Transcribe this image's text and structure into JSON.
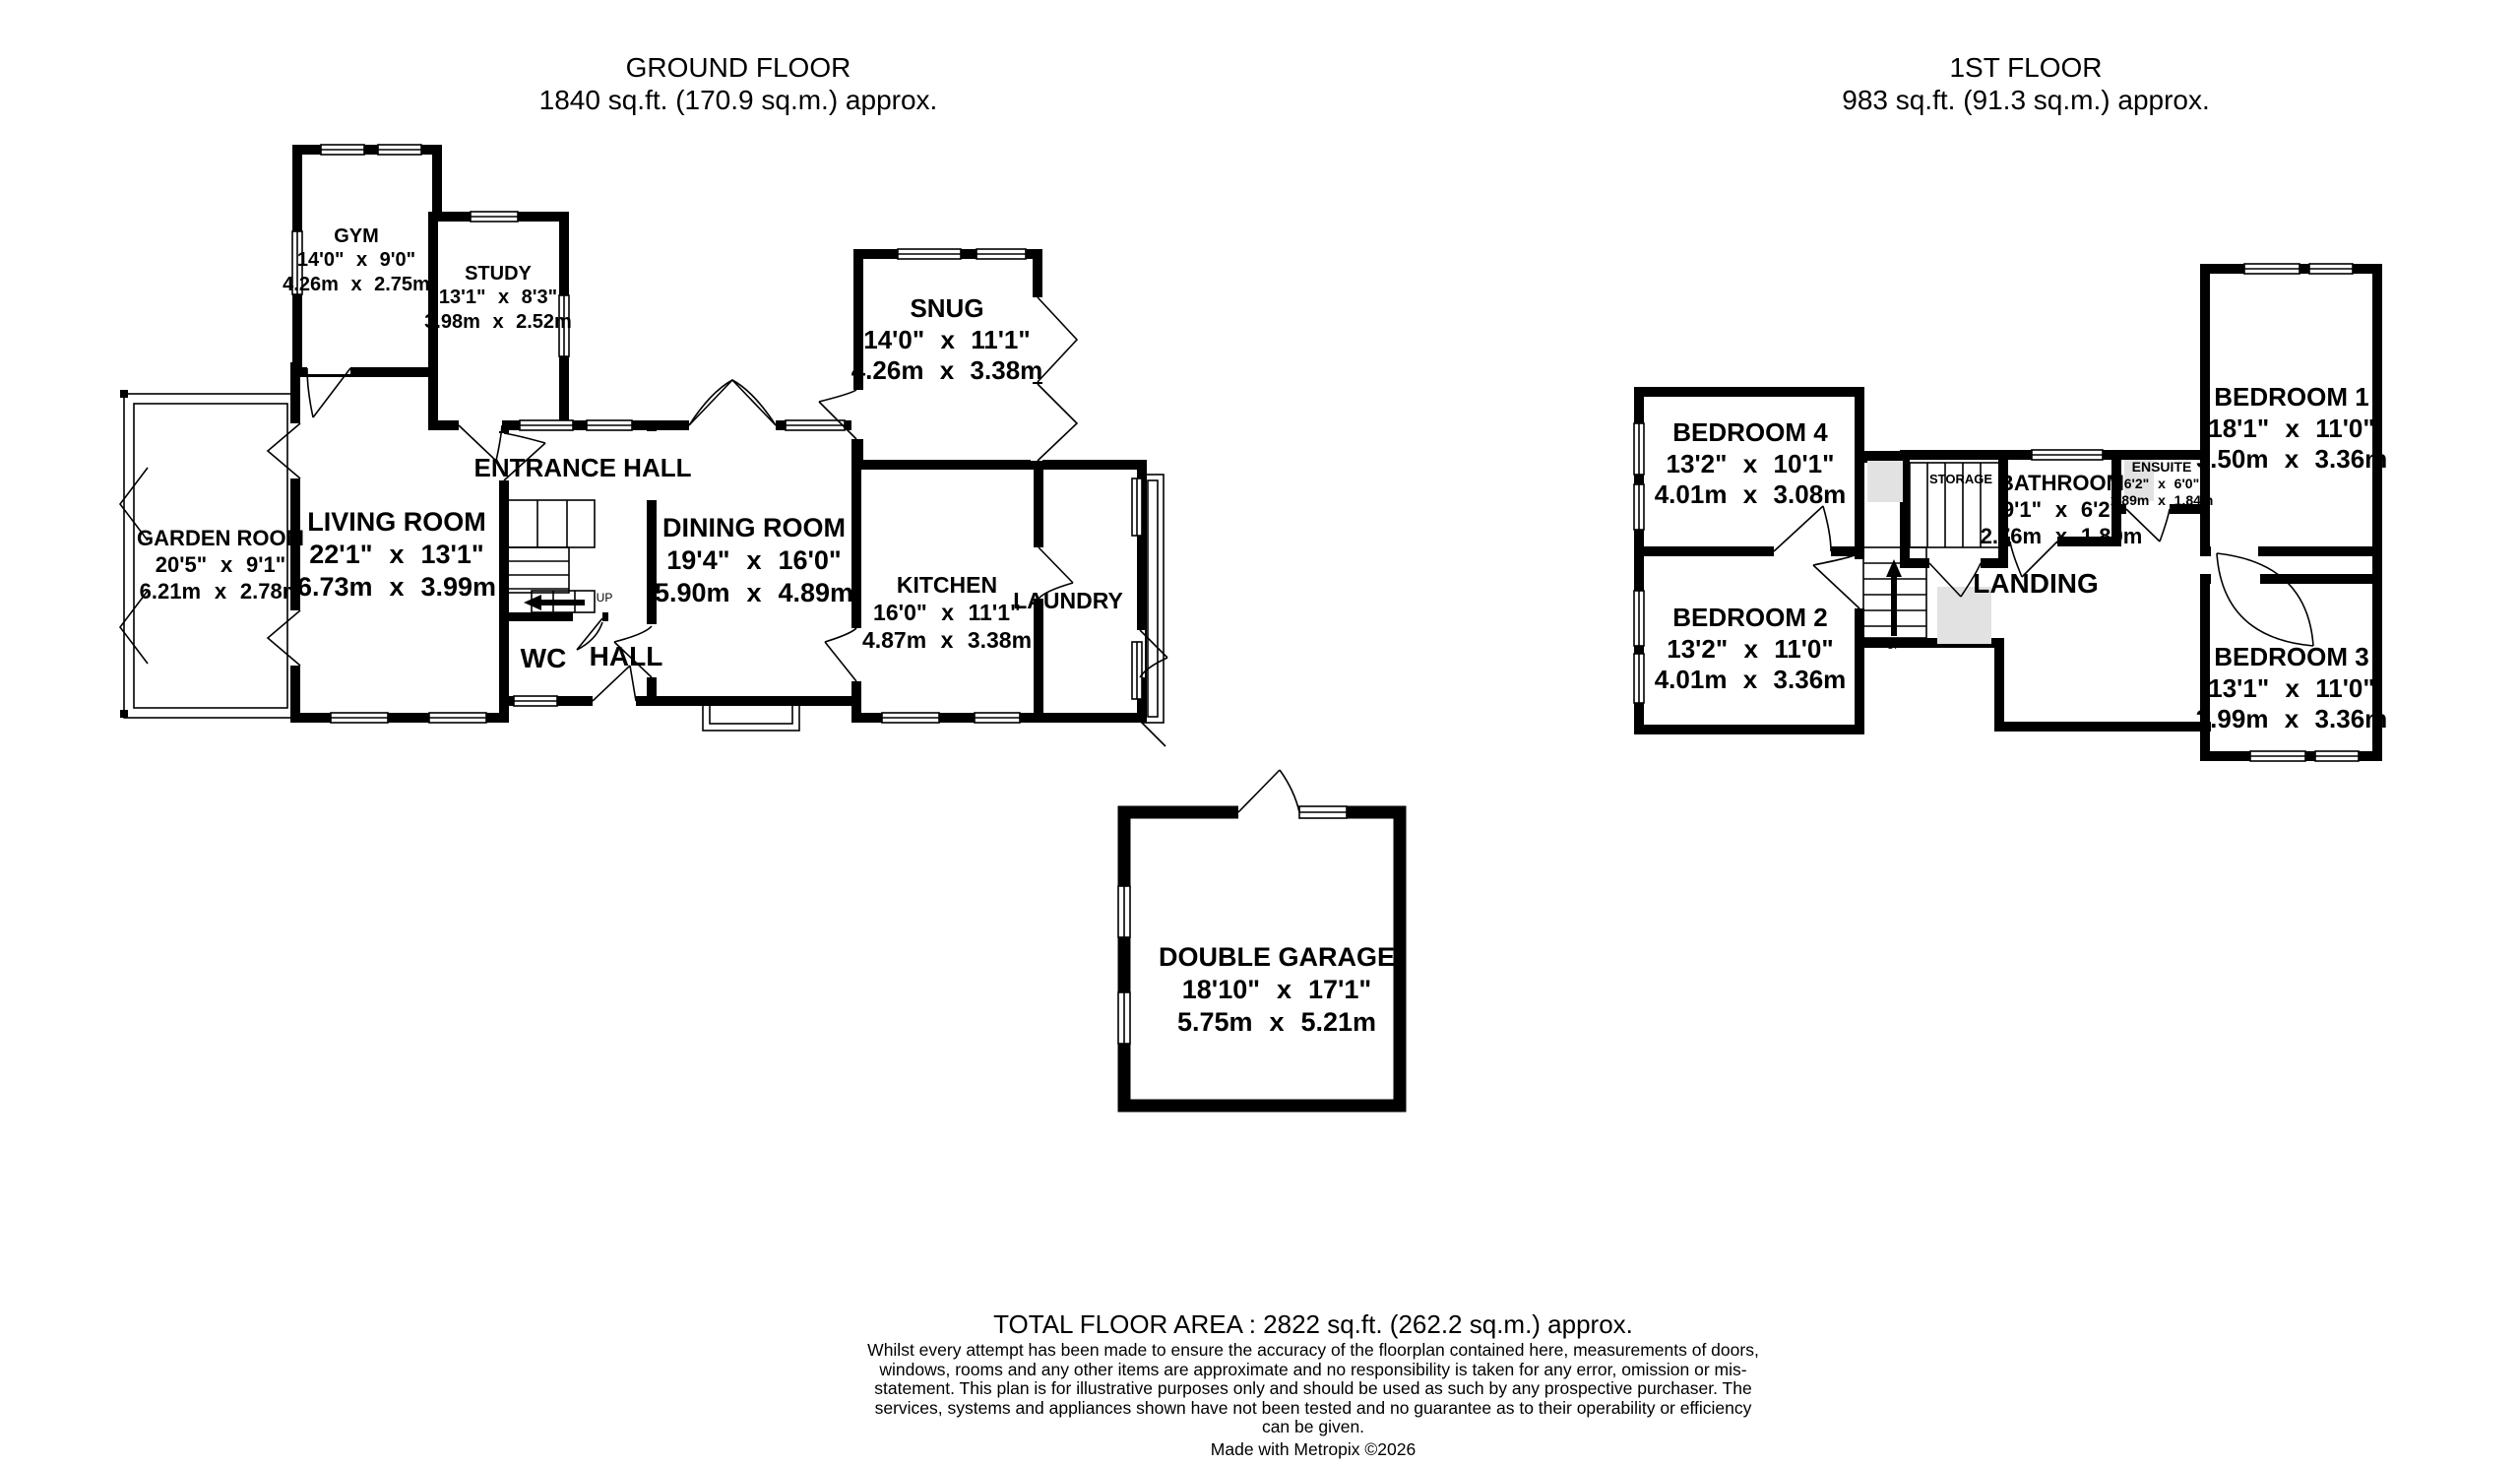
{
  "colors": {
    "wall": "#000000",
    "background": "#ffffff",
    "shading": "#e2e2e2"
  },
  "ground_floor": {
    "title": "GROUND FLOOR",
    "area": "1840 sq.ft. (170.9 sq.m.) approx.",
    "rooms": {
      "gym": {
        "name": "GYM",
        "imperial": "14'0\" x 9'0\"",
        "metric": "4.26m x 2.75m"
      },
      "study": {
        "name": "STUDY",
        "imperial": "13'1\" x 8'3\"",
        "metric": "3.98m x 2.52m"
      },
      "snug": {
        "name": "SNUG",
        "imperial": "14'0\" x 11'1\"",
        "metric": "4.26m x 3.38m"
      },
      "garden_room": {
        "name": "GARDEN ROOM",
        "imperial": "20'5\" x 9'1\"",
        "metric": "6.21m x 2.78m"
      },
      "living_room": {
        "name": "LIVING ROOM",
        "imperial": "22'1\" x 13'1\"",
        "metric": "6.73m x 3.99m"
      },
      "dining_room": {
        "name": "DINING ROOM",
        "imperial": "19'4\" x 16'0\"",
        "metric": "5.90m x 4.89m"
      },
      "kitchen": {
        "name": "KITCHEN",
        "imperial": "16'0\" x 11'1\"",
        "metric": "4.87m x 3.38m"
      },
      "entrance_hall": {
        "name": "ENTRANCE HALL"
      },
      "laundry": {
        "name": "LAUNDRY"
      },
      "wc": {
        "name": "WC"
      },
      "hall": {
        "name": "HALL"
      },
      "up": "UP"
    }
  },
  "first_floor": {
    "title": "1ST FLOOR",
    "area": "983 sq.ft. (91.3 sq.m.) approx.",
    "rooms": {
      "bedroom1": {
        "name": "BEDROOM 1",
        "imperial": "18'1\" x 11'0\"",
        "metric": "5.50m x 3.36m"
      },
      "bedroom2": {
        "name": "BEDROOM 2",
        "imperial": "13'2\" x 11'0\"",
        "metric": "4.01m x 3.36m"
      },
      "bedroom3": {
        "name": "BEDROOM 3",
        "imperial": "13'1\" x 11'0\"",
        "metric": "3.99m x 3.36m"
      },
      "bedroom4": {
        "name": "BEDROOM 4",
        "imperial": "13'2\" x 10'1\"",
        "metric": "4.01m x 3.08m"
      },
      "bathroom": {
        "name": "BATHROOM",
        "imperial": "9'1\" x 6'2\"",
        "metric": "2.76m x 1.89m"
      },
      "ensuite": {
        "name": "ENSUITE",
        "imperial": "6'2\" x 6'0\"",
        "metric": "1.89m x 1.84m"
      },
      "storage": {
        "name": "STORAGE"
      },
      "landing": {
        "name": "LANDING"
      },
      "up": "UP"
    }
  },
  "garage": {
    "rooms": {
      "double_garage": {
        "name": "DOUBLE GARAGE",
        "imperial": "18'10\" x 17'1\"",
        "metric": "5.75m x 5.21m"
      }
    }
  },
  "footer": {
    "total": "TOTAL FLOOR AREA : 2822 sq.ft. (262.2 sq.m.) approx.",
    "disclaimer": "Whilst every attempt has been made to ensure the accuracy of the floorplan contained here, measurements of doors, windows, rooms and any other items are approximate and no responsibility is taken for any error, omission or mis-statement. This plan is for illustrative purposes only and should be used as such by any prospective purchaser. The services, systems and appliances shown have not been tested and no guarantee as to their operability or efficiency can be given.",
    "credit": "Made with Metropix ©2026"
  }
}
